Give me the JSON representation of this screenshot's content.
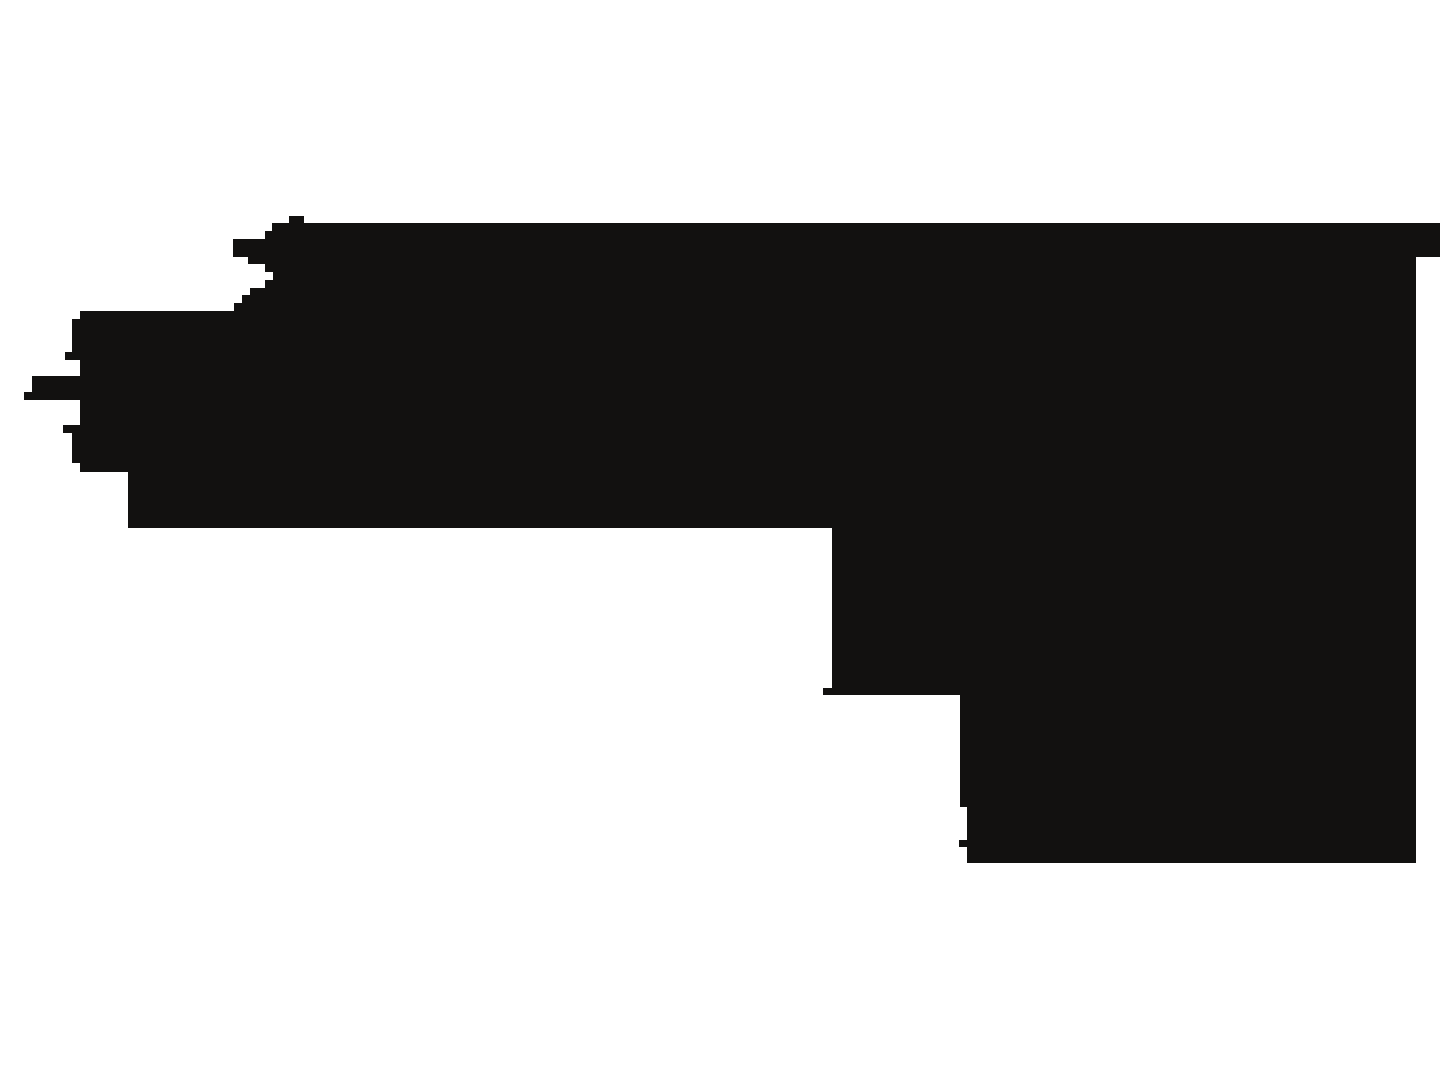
{
  "canvas": {
    "width_px": 1440,
    "height_px": 1080,
    "background": "#ffffff",
    "viewbox": "0 0 1440 1080"
  },
  "silhouette": {
    "alt": "Large black pixelated silhouette on a white background: flat top edge, jagged stair-stepped left edge with three pointed spike protrusions, flat bottom edge that steps down twice toward the lower right, right side touching the image edge in a short band near the top",
    "fill": "#121110",
    "points_attr": "272,231 272,223 289,223 289,216 304,216 304,223 1440,223 1440,257 1416,257 1416,863 967,863 967,847 959,847 959,840 967,840 967,807 960,807 960,695 823,695 823,688 832,688 832,528 128,528 128,472 80,472 80,463 72,463 72,433 63,433 63,425 80,425 80,400 24,400 24,392 32,392 32,376 80,376 80,360 65,360 65,352 72,352 72,319 80,319 80,311 234,311 234,303 242,303 242,295 250,295 250,288 265,288 265,280 273,280 273,272 265,272 265,264 248,264 248,257 233,257 233,239 265,239 265,231"
  }
}
